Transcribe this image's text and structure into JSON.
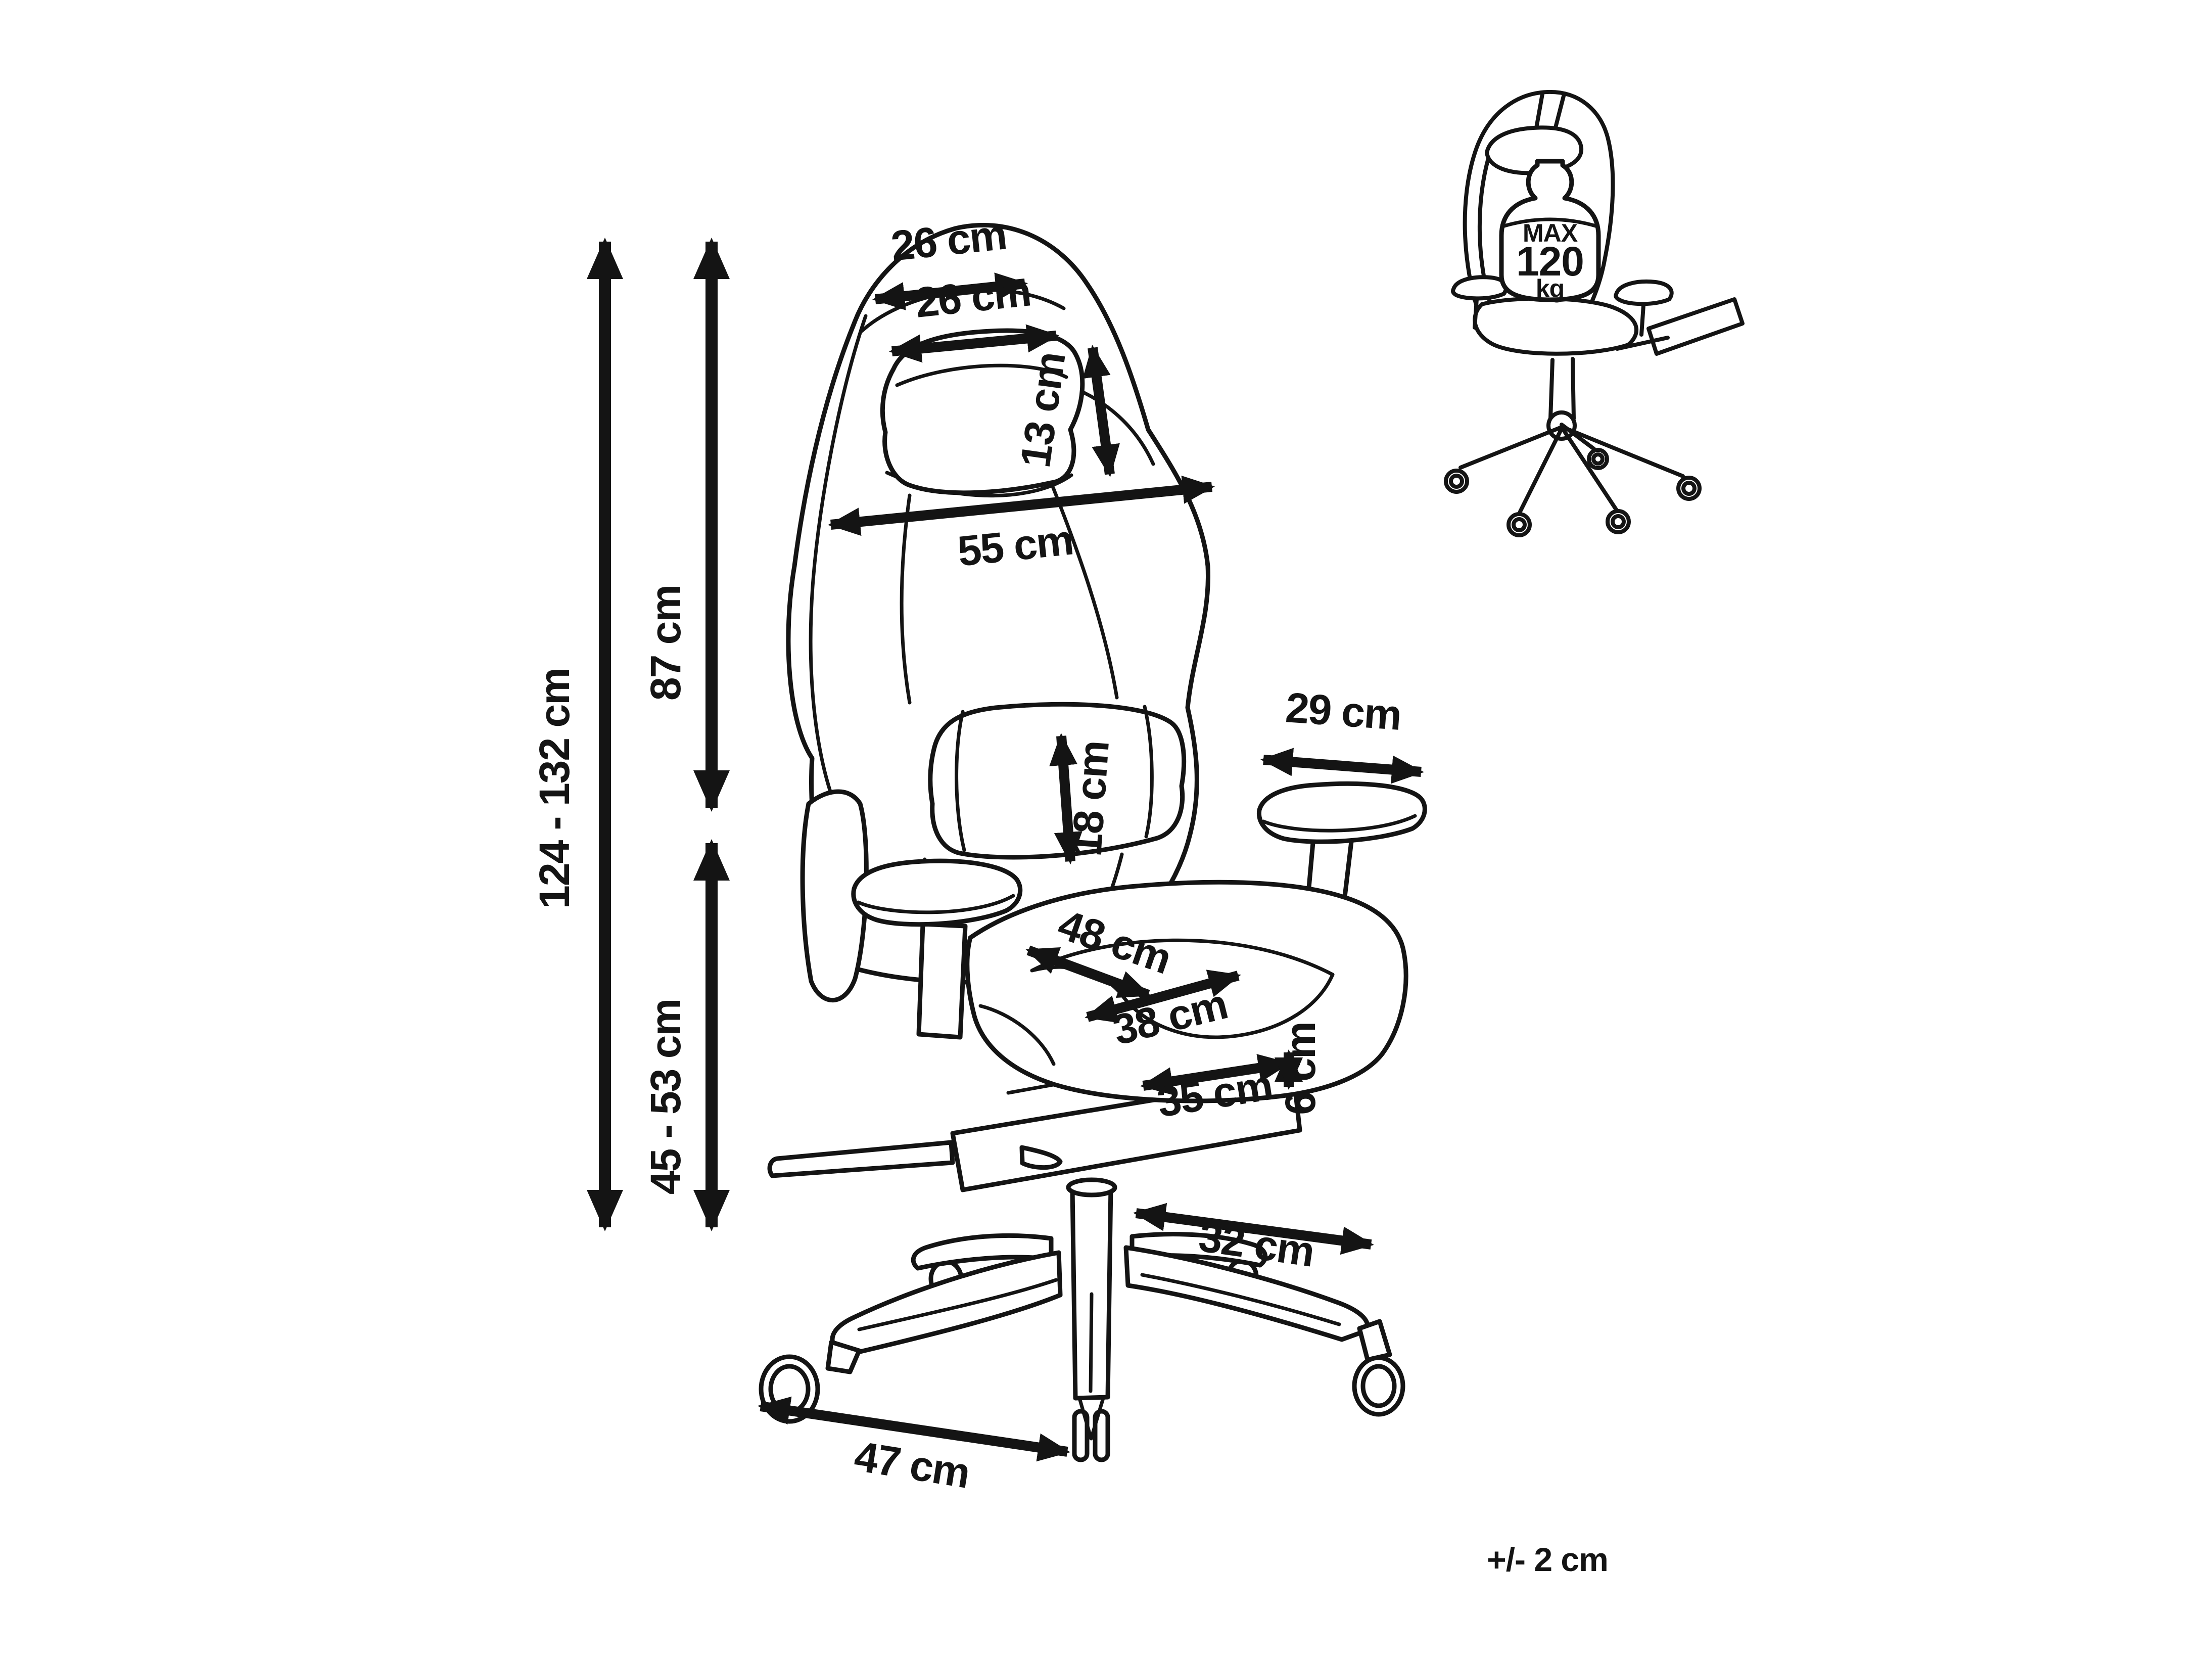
{
  "diagram": {
    "type": "product-dimension-diagram",
    "subject": "gaming chair",
    "ink_color": "#141414",
    "background_color": "#ffffff"
  },
  "dimensions": {
    "headrest_width": "26 cm",
    "headrest_pillow_width": "26 cm",
    "headrest_pillow_height": "13 cm",
    "backrest_width": "55 cm",
    "backrest_height": "87 cm",
    "total_height": "124 - 132 cm",
    "lumbar_pillow_height": "18 cm",
    "armrest_length": "29 cm",
    "seat_depth": "48 cm",
    "seat_inner_width": "38 cm",
    "footrest_length": "35 cm",
    "footrest_thickness": "6 cm",
    "seat_height": "45 - 53 cm",
    "base_leg_length": "32 cm",
    "base_span": "47 cm"
  },
  "max_load": {
    "line1": "MAX",
    "line2": "120",
    "line3": "kg"
  },
  "tolerance": "+/- 2 cm"
}
